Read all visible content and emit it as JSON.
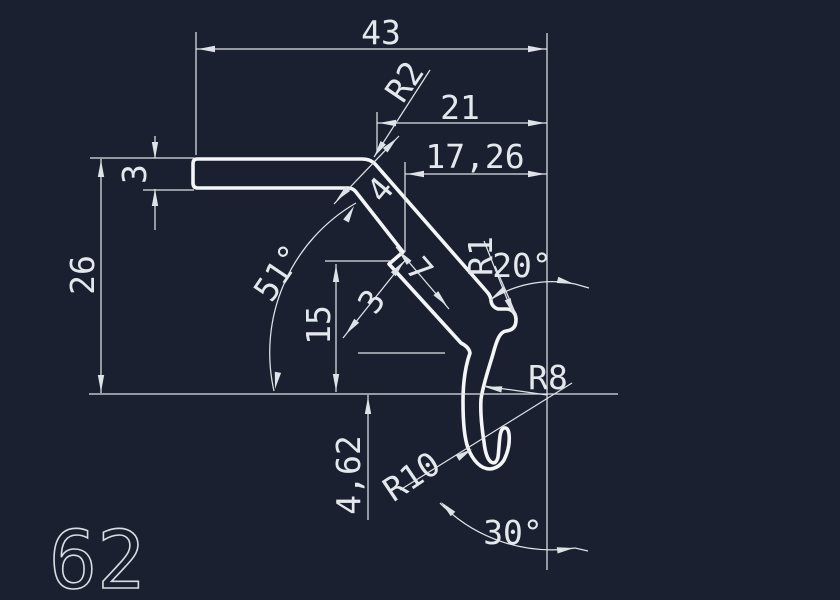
{
  "drawing": {
    "app": "cad-model-space",
    "profile_number": "62",
    "background": "#1a2030",
    "stroke": "#f3f5f7",
    "dim_color": "#dfe3e7",
    "text_color": "#e4e8ec",
    "labels": {
      "d43": "43",
      "r2": "R2",
      "d21": "21",
      "d1726": "17,26",
      "t3bar": "3",
      "d26": "26",
      "a51": "51°",
      "d4": "4",
      "d15": "15",
      "t3step": "3",
      "d7": "7",
      "r1": "R1",
      "a20": "20°",
      "r8": "R8",
      "r10": "R10",
      "d462": "4,62",
      "a30": "30°",
      "num": "62"
    }
  }
}
